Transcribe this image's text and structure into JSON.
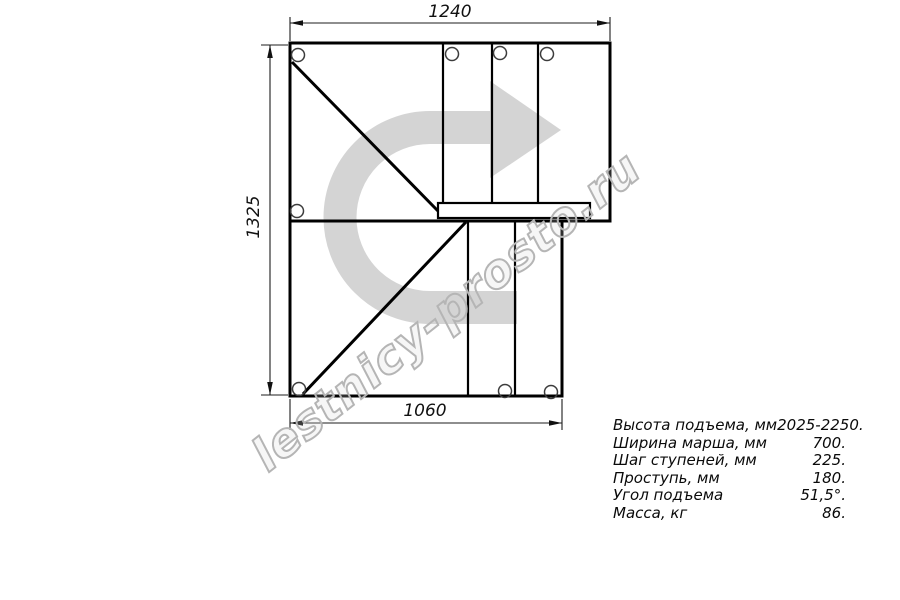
{
  "drawing": {
    "title": "staircase-plan-view",
    "watermark_text": "lestnicy-prosto.ru",
    "dimensions": {
      "top": "1240",
      "left": "1325",
      "bottom": "1060"
    },
    "arrow_icon": "u-turn-right-direction-arrow",
    "colors": {
      "arrow": "#d4d4d4",
      "watermark_outline": "#b5b5b5",
      "line": "#000000"
    }
  },
  "specs": {
    "rows": [
      {
        "label": "Высота подъема, мм",
        "value": "2025-2250."
      },
      {
        "label": "Ширина марша, мм",
        "value": "700."
      },
      {
        "label": "Шаг ступеней, мм",
        "value": "225."
      },
      {
        "label": "Проступь, мм",
        "value": "180."
      },
      {
        "label": "Угол подъема",
        "value": "51,5°."
      },
      {
        "label": "Масса, кг",
        "value": "86."
      }
    ]
  }
}
